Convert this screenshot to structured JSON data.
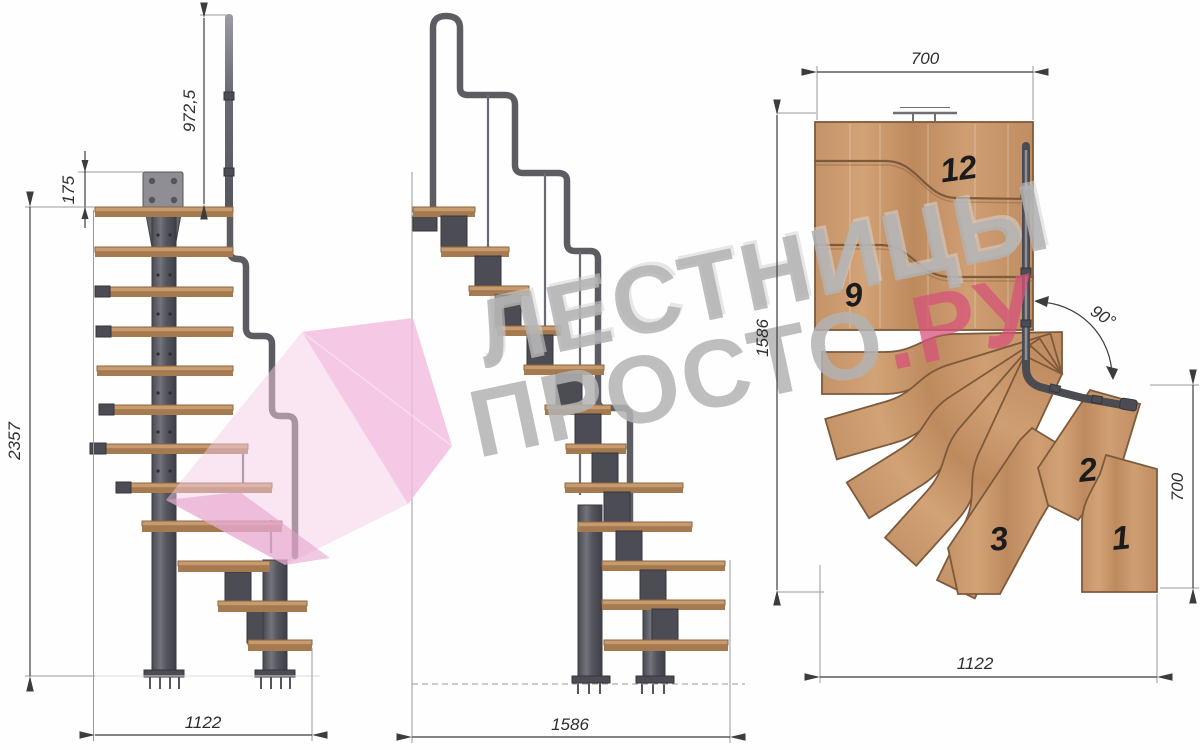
{
  "watermark": {
    "line1": "ЛЕСТНИЦЫ",
    "line2": "ПРОСТО",
    "line2_accent": ".РУ"
  },
  "front_view": {
    "dim_handrail_height": "972,5",
    "dim_top_plate": "175",
    "dim_total_height": "2357",
    "dim_base_width": "1122"
  },
  "side_view": {
    "dim_total_run": "1586"
  },
  "plan_view": {
    "dim_top_width": "700",
    "dim_left_run": "1586",
    "dim_right_depth": "700",
    "dim_bottom_width": "1122",
    "dim_turn_angle": "90°",
    "step_numbers": {
      "s12": "12",
      "s9": "9",
      "s3": "3",
      "s2": "2",
      "s1": "1"
    }
  },
  "colors": {
    "wood": "#c2946a",
    "wood_edge": "#7d5a3c",
    "metal": "#5d5d64",
    "metal_dark": "#4c4c54",
    "dim_line": "#3c3c3c",
    "watermark_gray": "#b3b3b3",
    "watermark_pink": "#d7547a",
    "arrow_pink": "#f0b9dc"
  }
}
